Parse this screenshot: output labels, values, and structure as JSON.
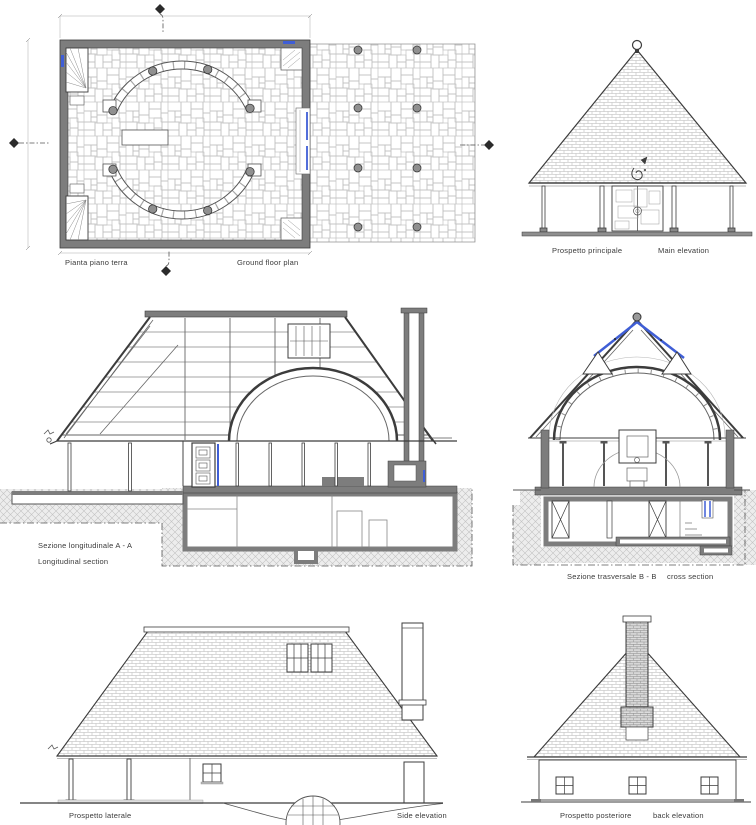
{
  "colors": {
    "accent_blue": "#3f5ed6",
    "wall_gray": "#7d7d7d",
    "line_dark": "#3c3c3c"
  },
  "panels": {
    "ground_floor_plan": {
      "label_it": "Pianta piano terra",
      "label_en": "Ground floor plan"
    },
    "main_elevation": {
      "label_it": "Prospetto principale",
      "label_en": "Main elevation"
    },
    "longitudinal_section": {
      "label_it": "Sezione longitudinale A - A",
      "label_en": "Longitudinal section"
    },
    "cross_section": {
      "label_it": "Sezione trasversale B - B",
      "label_en": "cross section"
    },
    "side_elevation": {
      "label_it": "Prospetto laterale",
      "label_en": "Side elevation"
    },
    "back_elevation": {
      "label_it": "Prospetto posteriore",
      "label_en": "back elevation"
    }
  }
}
